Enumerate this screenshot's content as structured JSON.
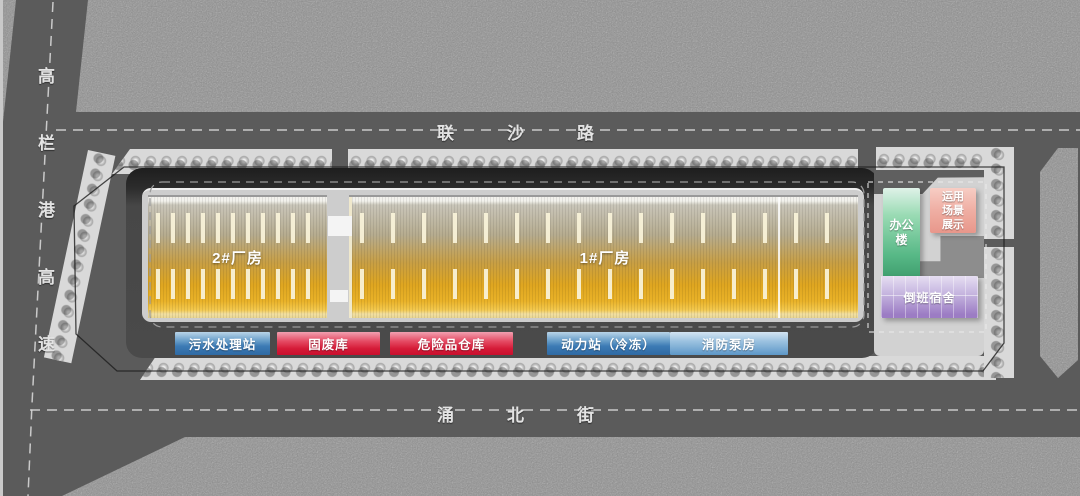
{
  "roads": {
    "left": {
      "chars": [
        "高",
        "栏",
        "港",
        "高",
        "速"
      ]
    },
    "top": {
      "chars": [
        "联",
        "沙",
        "路"
      ]
    },
    "bottom": {
      "chars": [
        "涌",
        "北",
        "街"
      ]
    }
  },
  "factories": {
    "f2": {
      "label": "2#厂房"
    },
    "f1": {
      "label": "1#厂房"
    }
  },
  "facilities": [
    {
      "label": "污水处理站"
    },
    {
      "label": "固废库"
    },
    {
      "label": "危险品仓库"
    },
    {
      "label": "动力站（冷冻）"
    },
    {
      "label": "消防泵房"
    }
  ],
  "campus": {
    "office": {
      "label": "办公楼"
    },
    "display": {
      "lines": [
        "运用",
        "场景",
        "展示"
      ]
    },
    "dormitory": {
      "label": "倒班宿舍"
    }
  },
  "colors": {
    "factory_gold": "#e2a81f",
    "facility_blue": "#3c7ab4",
    "facility_light_blue": "#5d97c8",
    "facility_red": "#d51b38",
    "office_green": "#4fb07e",
    "display_pink": "#ea9a8e",
    "dormitory_purple": "#9c7cc4",
    "road_asphalt": "#5b5b5b",
    "ground_noise": "#8f8f8f",
    "tree_band": "#d9d9d9"
  }
}
